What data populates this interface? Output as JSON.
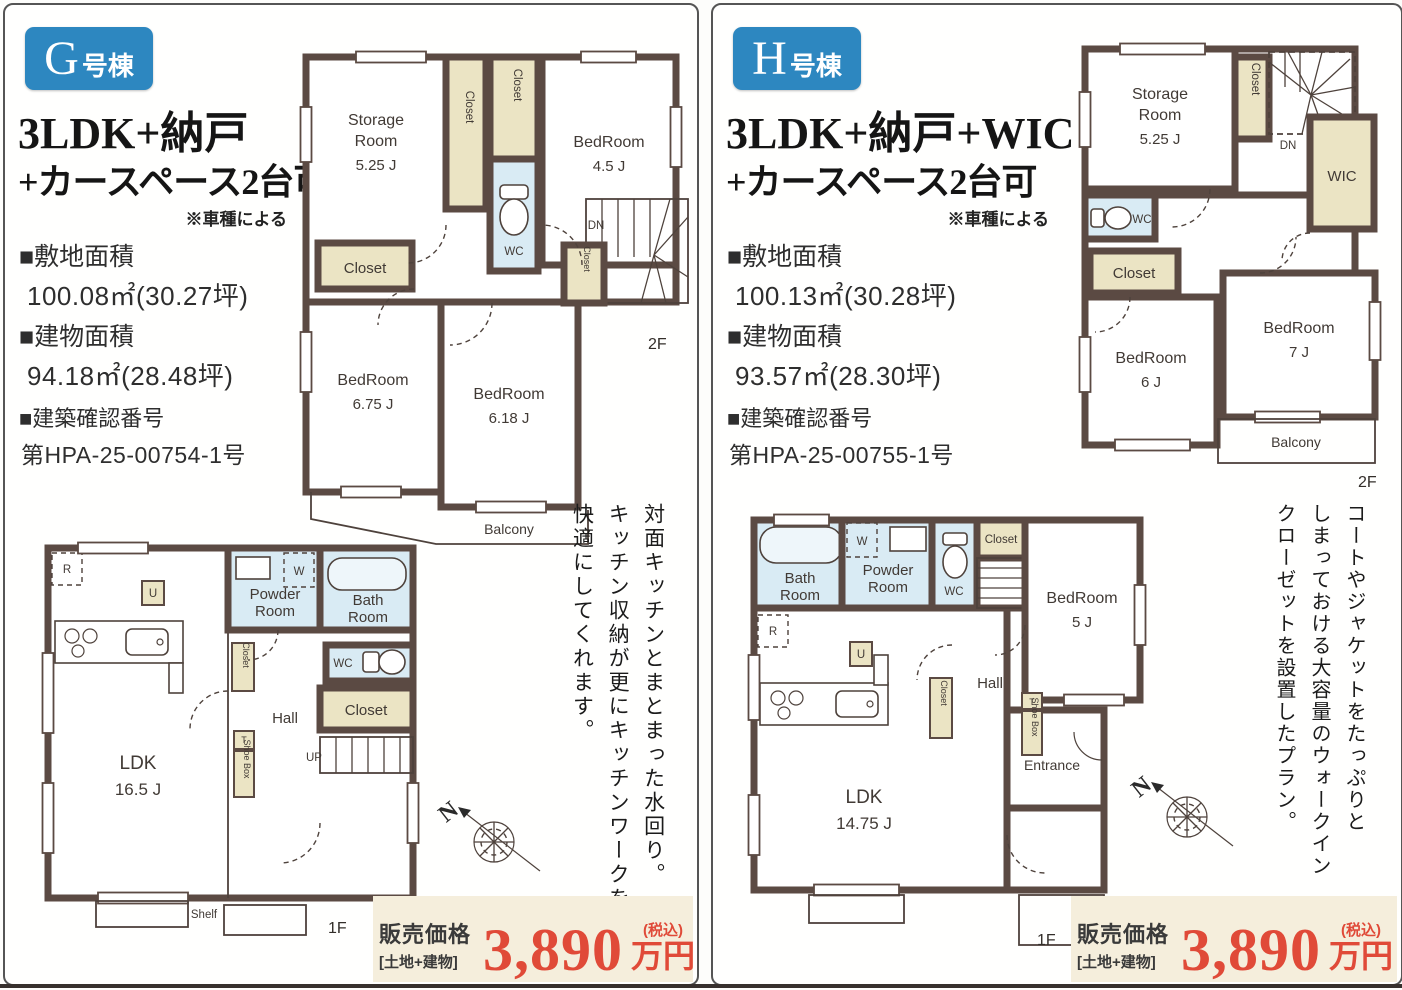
{
  "labels": {
    "closet": "Closet",
    "wc": "WC",
    "wic": "WIC",
    "dn": "DN",
    "up": "UP",
    "balcony": "Balcony",
    "hall": "Hall",
    "shelf": "Shelf",
    "shoe_box": "Shoe Box",
    "entrance": "Entrance",
    "floor_1f": "1F",
    "floor_2f": "2F",
    "bedroom": "BedRoom",
    "storage_1": "Storage",
    "storage_2": "Room",
    "powder_1": "Powder",
    "powder_2": "Room",
    "bath_1": "Bath",
    "bath_2": "Room",
    "ldk": "LDK",
    "u": "U",
    "r": "R",
    "w": "W",
    "t": "T",
    "n": "N"
  },
  "panels": [
    {
      "badge_letter": "G",
      "badge_suffix": "号棟",
      "title_line1": "3LDK+納戸",
      "title_line2": "+カースペース2台可",
      "note": "※車種による",
      "specs": [
        {
          "label": "■敷地面積",
          "value": "100.08㎡(30.27坪)"
        },
        {
          "label": "■建物面積",
          "value": "94.18㎡(28.48坪)"
        },
        {
          "label": "■建築確認番号",
          "value": "第HPA-25-00754-1号"
        }
      ],
      "sizes": {
        "storage": "5.25 J",
        "bed_a": "4.5 J",
        "bed_b": "6.75 J",
        "bed_c": "6.18 J",
        "ldk": "16.5 J"
      },
      "desc": [
        "対面キッチンとまとまった水回り。",
        "キッチン収納が更にキッチンワークを",
        "快適にしてくれます。"
      ],
      "price": {
        "label": "販売価格",
        "sub": "[土地+建物]",
        "value": "3,890",
        "tax": "(税込)",
        "unit": "万円"
      }
    },
    {
      "badge_letter": "H",
      "badge_suffix": "号棟",
      "title_line1": "3LDK+納戸+WIC",
      "title_line2": "+カースペース2台可",
      "note": "※車種による",
      "specs": [
        {
          "label": "■敷地面積",
          "value": "100.13㎡(30.28坪)"
        },
        {
          "label": "■建物面積",
          "value": "93.57㎡(28.30坪)"
        },
        {
          "label": "■建築確認番号",
          "value": "第HPA-25-00755-1号"
        }
      ],
      "sizes": {
        "storage": "5.25 J",
        "bed_a": "7 J",
        "bed_b": "6 J",
        "bed_c": "5 J",
        "ldk": "14.75 J"
      },
      "desc": [
        "コートやジャケットをたっぷりと",
        "しまっておける大容量のウォークイン",
        "クローゼットを設置したプラン。"
      ],
      "price": {
        "label": "販売価格",
        "sub": "[土地+建物]",
        "value": "3,890",
        "tax": "(税込)",
        "unit": "万円"
      }
    }
  ]
}
